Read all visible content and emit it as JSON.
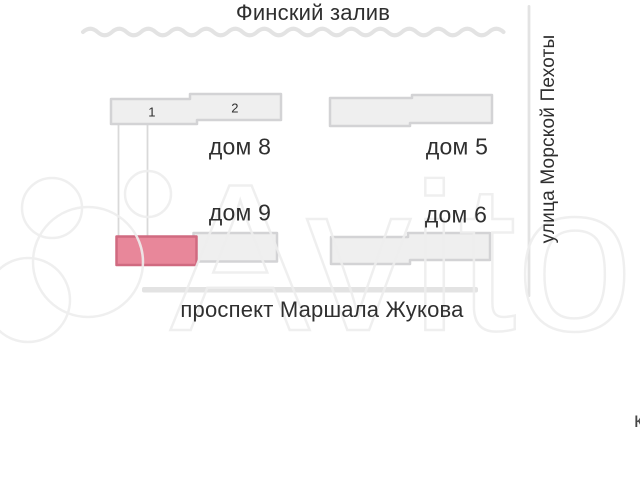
{
  "map": {
    "waterfront_label": "Финский залив",
    "right_street_label": "улица Морской Пехоты",
    "bottom_street_label": "проспект Маршала Жукова",
    "house_8": {
      "label": "дом 8",
      "unit_1": "1",
      "unit_2": "2"
    },
    "house_5": {
      "label": "дом 5"
    },
    "house_9": {
      "label": "дом 9"
    },
    "house_6": {
      "label": "дом 6"
    },
    "edge_partial_text": "к"
  },
  "watermark": {
    "text": "Avito"
  },
  "colors": {
    "highlight_fill": "#e8879a",
    "highlight_stroke": "#d06a80",
    "building_fill": "#efefef",
    "building_stroke": "#d3d3d5",
    "road": "#e3e3e3",
    "callout": "#d9d9d9",
    "label_text": "#2f2f2f",
    "watermark": "#eeeeee"
  }
}
